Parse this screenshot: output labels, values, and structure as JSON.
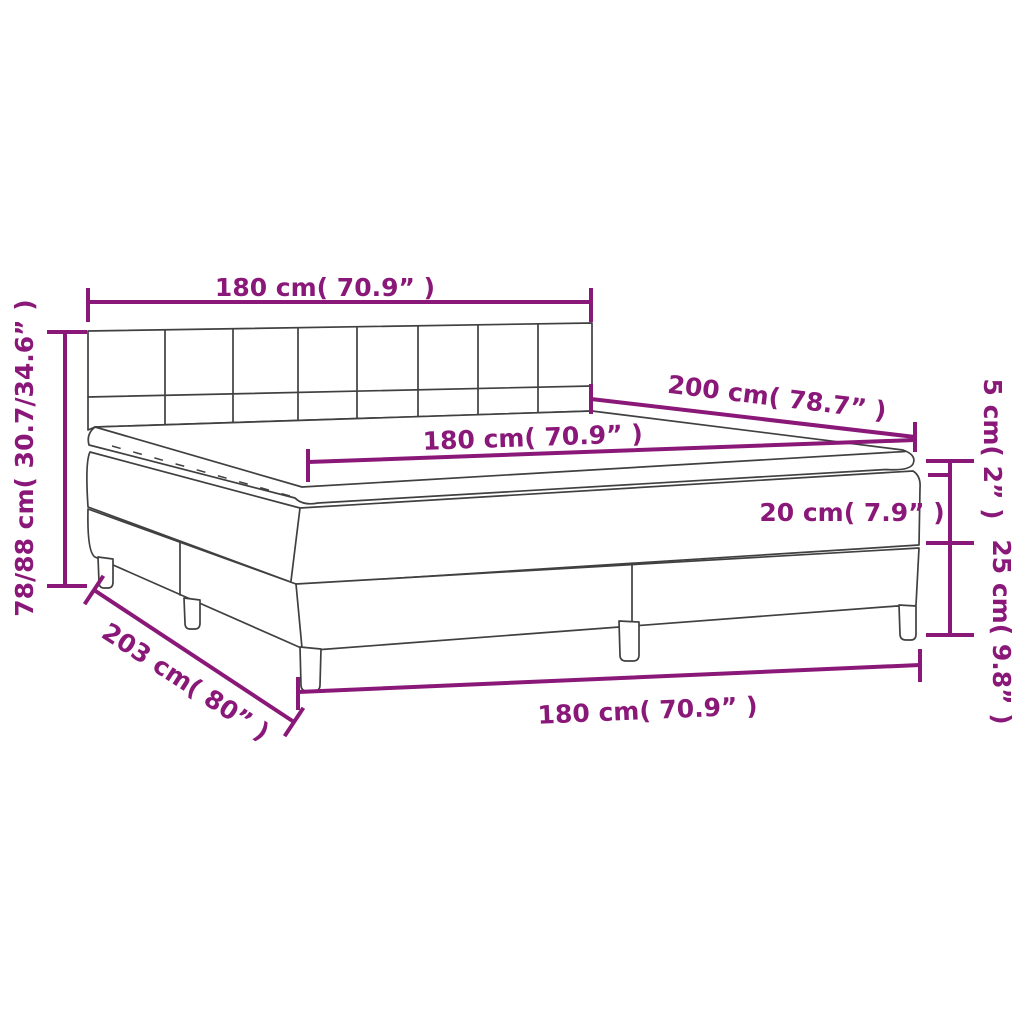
{
  "diagram": {
    "type": "product-dimension-diagram",
    "subject": "box-spring-bed-with-headboard-topper-and-legs",
    "accent_color": "#8A1878",
    "line_color": "#404040",
    "labels": {
      "headboard_width": "180 cm( 70.9” )",
      "total_height": "78/88 cm( 30.7/34.6” )",
      "bed_length": "200 cm( 78.7” )",
      "mattress_width": "180 cm( 70.9” )",
      "topper_height": "5 cm( 2” )",
      "mattress_height": "20 cm( 7.9” )",
      "base_height": "25 cm( 9.8” )",
      "base_length": "203 cm( 80” )",
      "base_width": "180 cm( 70.9” )"
    }
  }
}
